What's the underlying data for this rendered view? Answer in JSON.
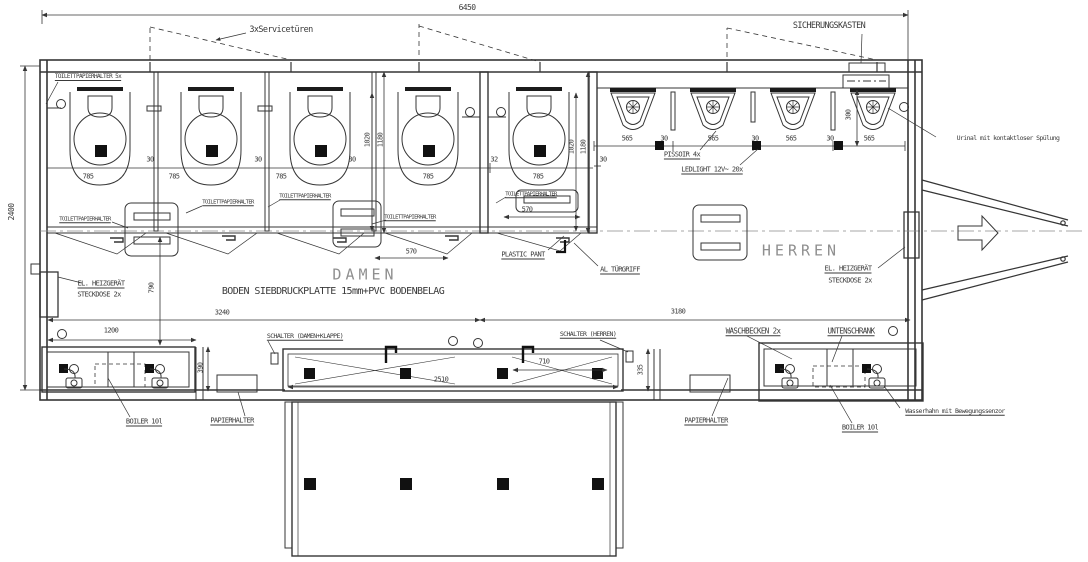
{
  "drawing": {
    "type": "floor-plan",
    "colors": {
      "line": "#353535",
      "accent_fill": "#111111",
      "room_text": "#8f8f8f",
      "background": "#ffffff"
    },
    "rooms": {
      "left": "DAMEN",
      "right": "HERREN"
    }
  },
  "labels": [
    {
      "name": "dim-overall-width",
      "text": "6450",
      "x": 467,
      "y": 8,
      "size": 8
    },
    {
      "name": "dim-overall-depth",
      "text": "2400",
      "x": 12,
      "y": 212,
      "size": 8,
      "rot": true
    },
    {
      "name": "label-service-doors",
      "text": "3xServicetüren",
      "x": 281,
      "y": 30,
      "size": 8.5
    },
    {
      "name": "label-fusebox",
      "text": "SICHERUNGSKASTEN",
      "x": 829,
      "y": 26,
      "size": 8.5
    },
    {
      "name": "label-tp-holder-5x",
      "text": "TOILETTPAPIERHALTER 5x",
      "x": 88,
      "y": 77,
      "size": 6,
      "ul": true
    },
    {
      "name": "dim-stall1-width",
      "text": "785",
      "x": 88,
      "y": 177,
      "size": 7
    },
    {
      "name": "dim-stall2-width",
      "text": "785",
      "x": 174,
      "y": 177,
      "size": 7
    },
    {
      "name": "dim-stall3-width",
      "text": "785",
      "x": 281,
      "y": 177,
      "size": 7
    },
    {
      "name": "dim-stall4-width",
      "text": "785",
      "x": 428,
      "y": 177,
      "size": 7
    },
    {
      "name": "dim-stall5-width",
      "text": "785",
      "x": 538,
      "y": 177,
      "size": 7
    },
    {
      "name": "dim-partition1",
      "text": "30",
      "x": 150,
      "y": 160,
      "size": 7
    },
    {
      "name": "dim-partition2",
      "text": "30",
      "x": 258,
      "y": 160,
      "size": 7
    },
    {
      "name": "dim-partition3",
      "text": "30",
      "x": 352,
      "y": 160,
      "size": 7
    },
    {
      "name": "dim-partition4",
      "text": "32",
      "x": 494,
      "y": 160,
      "size": 7
    },
    {
      "name": "dim-stall-depth-inner-a",
      "text": "1020",
      "x": 368,
      "y": 140,
      "size": 7,
      "rot": true
    },
    {
      "name": "dim-stall-depth-outer-a",
      "text": "1180",
      "x": 381,
      "y": 140,
      "size": 7,
      "rot": true
    },
    {
      "name": "dim-stall-depth-inner-b",
      "text": "1020",
      "x": 572,
      "y": 147,
      "size": 7,
      "rot": true
    },
    {
      "name": "dim-stall-depth-outer-b",
      "text": "1180",
      "x": 584,
      "y": 147,
      "size": 7,
      "rot": true
    },
    {
      "name": "dim-urinal1",
      "text": "565",
      "x": 627,
      "y": 139,
      "size": 7
    },
    {
      "name": "dim-urinal-gap1",
      "text": "30",
      "x": 664,
      "y": 139,
      "size": 7
    },
    {
      "name": "dim-urinal2",
      "text": "565",
      "x": 713,
      "y": 139,
      "size": 7
    },
    {
      "name": "dim-urinal-gap2",
      "text": "30",
      "x": 755,
      "y": 139,
      "size": 7
    },
    {
      "name": "dim-urinal3",
      "text": "565",
      "x": 791,
      "y": 139,
      "size": 7
    },
    {
      "name": "dim-urinal-gap3",
      "text": "30",
      "x": 830,
      "y": 139,
      "size": 7
    },
    {
      "name": "dim-urinal4",
      "text": "565",
      "x": 869,
      "y": 139,
      "size": 7
    },
    {
      "name": "dim-urinal-offset",
      "text": "30",
      "x": 603,
      "y": 160,
      "size": 7
    },
    {
      "name": "dim-urinal-height",
      "text": "300",
      "x": 849,
      "y": 115,
      "size": 7,
      "rot": true
    },
    {
      "name": "label-pissoir",
      "text": "PISSOIR 4x",
      "x": 682,
      "y": 155,
      "size": 7,
      "ul": true
    },
    {
      "name": "label-ledlight",
      "text": "LEDLIGHT 12V~ 20x",
      "x": 712,
      "y": 170,
      "size": 7,
      "ul": true
    },
    {
      "name": "label-urinal-flush",
      "text": "Urinal mit kontaktloser Spülung",
      "x": 1008,
      "y": 138,
      "size": 6.5
    },
    {
      "name": "label-tp-holder-1",
      "text": "TOILETTPAPIERHALTER",
      "x": 85,
      "y": 220,
      "size": 5.5,
      "ul": true
    },
    {
      "name": "label-tp-holder-2",
      "text": "TOILETTPAPIERHALTER",
      "x": 228,
      "y": 203,
      "size": 5.5,
      "ul": true
    },
    {
      "name": "label-tp-holder-3",
      "text": "TOILETTPAPIERHALTER",
      "x": 305,
      "y": 197,
      "size": 5.5,
      "ul": true
    },
    {
      "name": "label-tp-holder-4",
      "text": "TOILETTPAPIERHALTER",
      "x": 410,
      "y": 218,
      "size": 5.5,
      "ul": true
    },
    {
      "name": "label-tp-holder-5",
      "text": "TOILETTPAPIERHALTER",
      "x": 531,
      "y": 195,
      "size": 5.5,
      "ul": true
    },
    {
      "name": "dim-door-a",
      "text": "570",
      "x": 411,
      "y": 252,
      "size": 7
    },
    {
      "name": "dim-door-b",
      "text": "570",
      "x": 527,
      "y": 210,
      "size": 7
    },
    {
      "name": "label-plastic-panel",
      "text": "PLASTIC PANT",
      "x": 523,
      "y": 255,
      "size": 7,
      "ul": true
    },
    {
      "name": "label-door-handle",
      "text": "AL TÜRGRIFF",
      "x": 620,
      "y": 270,
      "size": 7,
      "ul": true
    },
    {
      "name": "room-damen",
      "text": "DAMEN",
      "x": 365,
      "y": 275,
      "size": 15,
      "cls": "room"
    },
    {
      "name": "label-floor-spec",
      "text": "BODEN SIEBDRUCKPLATTE 15mm+PVC BODENBELAG",
      "x": 333,
      "y": 292,
      "size": 10
    },
    {
      "name": "room-herren",
      "text": "HERREN",
      "x": 801,
      "y": 251,
      "size": 15,
      "cls": "room"
    },
    {
      "name": "label-heater-left-1",
      "text": "EL. HEIZGERÄT",
      "x": 101,
      "y": 284,
      "size": 7,
      "ul": true
    },
    {
      "name": "label-heater-left-2",
      "text": "STECKDOSE 2x",
      "x": 99,
      "y": 295,
      "size": 7
    },
    {
      "name": "label-heater-right-1",
      "text": "EL. HEIZGERÄT",
      "x": 848,
      "y": 269,
      "size": 7,
      "ul": true
    },
    {
      "name": "label-heater-right-2",
      "text": "STECKDOSE 2x",
      "x": 850,
      "y": 281,
      "size": 7
    },
    {
      "name": "dim-corridor",
      "text": "790",
      "x": 152,
      "y": 288,
      "size": 7,
      "rot": true
    },
    {
      "name": "dim-damen-width",
      "text": "3240",
      "x": 222,
      "y": 313,
      "size": 7
    },
    {
      "name": "dim-herren-width",
      "text": "3180",
      "x": 678,
      "y": 312,
      "size": 7
    },
    {
      "name": "dim-counter-left",
      "text": "1200",
      "x": 111,
      "y": 331,
      "size": 7
    },
    {
      "name": "label-switch-damen",
      "text": "SCHALTER (DAMEN+KLAPPE)",
      "x": 305,
      "y": 336,
      "size": 6.5,
      "ul": true
    },
    {
      "name": "label-switch-herren",
      "text": "SCHALTER (HERREN)",
      "x": 588,
      "y": 334,
      "size": 6.5,
      "ul": true
    },
    {
      "name": "dim-step-depth-left",
      "text": "390",
      "x": 201,
      "y": 368,
      "size": 7,
      "rot": true
    },
    {
      "name": "dim-step-depth-right",
      "text": "335",
      "x": 641,
      "y": 370,
      "size": 7,
      "rot": true
    },
    {
      "name": "dim-platform",
      "text": "2510",
      "x": 441,
      "y": 380,
      "size": 7
    },
    {
      "name": "dim-step-right",
      "text": "710",
      "x": 544,
      "y": 362,
      "size": 7
    },
    {
      "name": "label-waschbecken",
      "text": "WASCHBECKEN 2x",
      "x": 753,
      "y": 331,
      "size": 7.5,
      "ul": true
    },
    {
      "name": "label-unterschrank",
      "text": "UNTENSCHRANK",
      "x": 851,
      "y": 331,
      "size": 7.5,
      "ul": true
    },
    {
      "name": "label-boiler-left",
      "text": "BOILER 10l",
      "x": 144,
      "y": 422,
      "size": 7,
      "ul": true
    },
    {
      "name": "label-boiler-right",
      "text": "BOILER 10l",
      "x": 860,
      "y": 428,
      "size": 7,
      "ul": true
    },
    {
      "name": "label-paperholder-left",
      "text": "PAPIERHALTER",
      "x": 232,
      "y": 421,
      "size": 7,
      "ul": true
    },
    {
      "name": "label-paperholder-right",
      "text": "PAPIERHALTER",
      "x": 706,
      "y": 421,
      "size": 7,
      "ul": true
    },
    {
      "name": "label-faucet-sensor",
      "text": "Wasserhahn mit Bewegungssenzor",
      "x": 955,
      "y": 411,
      "size": 6.5,
      "ul": true
    }
  ]
}
